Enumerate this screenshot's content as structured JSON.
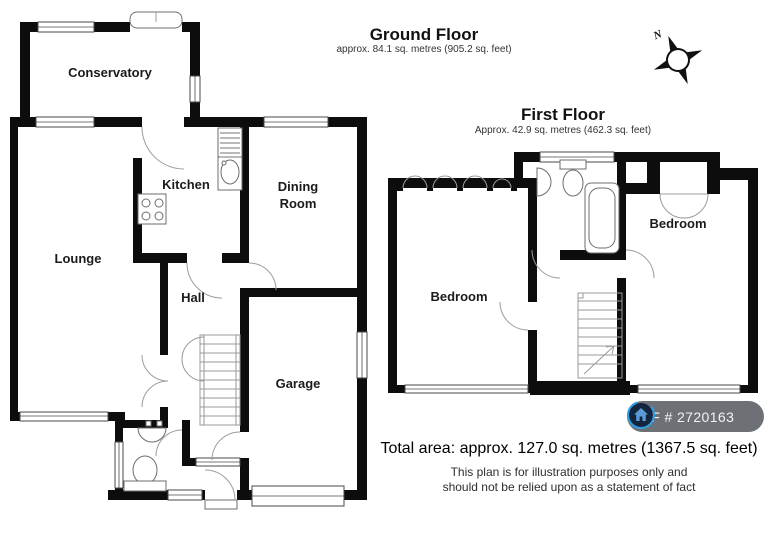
{
  "ground_floor": {
    "title": "Ground Floor",
    "subtitle": "approx. 84.1 sq. metres (905.2 sq. feet)",
    "rooms": [
      {
        "lines": [
          "Conservatory"
        ],
        "x": 110,
        "y": 77
      },
      {
        "lines": [
          "Kitchen"
        ],
        "x": 186,
        "y": 189
      },
      {
        "lines": [
          "Dining",
          "Room"
        ],
        "x": 298,
        "y": 191
      },
      {
        "lines": [
          "Lounge"
        ],
        "x": 78,
        "y": 263
      },
      {
        "lines": [
          "Hall"
        ],
        "x": 193,
        "y": 302
      },
      {
        "lines": [
          "Garage"
        ],
        "x": 298,
        "y": 388
      }
    ]
  },
  "first_floor": {
    "title": "First Floor",
    "subtitle": "Approx. 42.9 sq. metres (462.3 sq. feet)",
    "rooms": [
      {
        "lines": [
          "Bedroom"
        ],
        "x": 459,
        "y": 301
      },
      {
        "lines": [
          "Bedroom"
        ],
        "x": 678,
        "y": 228
      }
    ]
  },
  "compass": {
    "label": "N"
  },
  "ref_badge": {
    "label": "REF # 2720163",
    "bg": "#6d7175",
    "icon_bg": "#14253f",
    "icon_ring": "#2ea0e2",
    "icon_house": "#5b9bd5"
  },
  "footer": {
    "total_area": "Total area: approx. 127.0 sq. metres (1367.5 sq. feet)",
    "disclaimer_1": "This plan is for illustration purposes only and",
    "disclaimer_2": "should not be relied upon as a statement of fact"
  }
}
